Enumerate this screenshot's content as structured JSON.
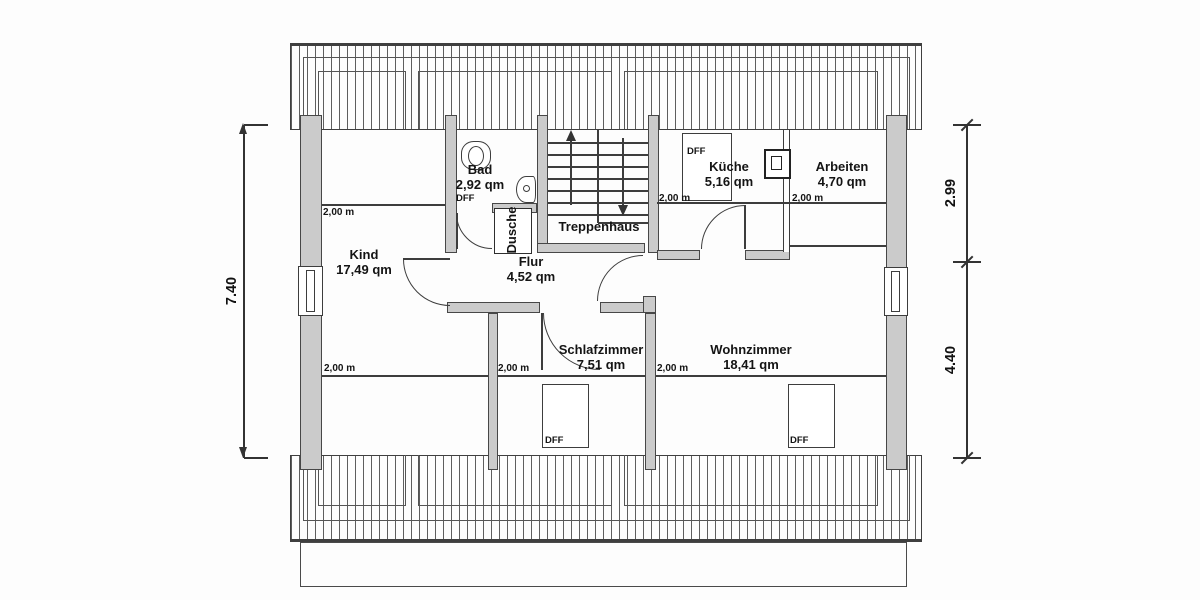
{
  "drawing": {
    "title": "Dachgeschoss Grundriss",
    "colors": {
      "wall_fill": "#cbcbcb",
      "line": "#3d3d3d",
      "background": "#fdfdfd"
    },
    "rooms": [
      {
        "id": "kind",
        "name": "Kind",
        "area": "17,49 qm",
        "cx": 364,
        "ty": 248,
        "rotated": false
      },
      {
        "id": "bad",
        "name": "Bad",
        "area": "2,92 qm",
        "cx": 480,
        "ty": 163,
        "rotated": false
      },
      {
        "id": "dusche",
        "name": "Dusche",
        "area": "",
        "cx": 512,
        "ty": 230,
        "rotated": true
      },
      {
        "id": "treppenhaus",
        "name": "Treppenhaus",
        "area": "",
        "cx": 599,
        "ty": 220,
        "rotated": false
      },
      {
        "id": "flur",
        "name": "Flur",
        "area": "4,52 qm",
        "cx": 531,
        "ty": 255,
        "rotated": false
      },
      {
        "id": "kueche",
        "name": "Küche",
        "area": "5,16 qm",
        "cx": 729,
        "ty": 160,
        "rotated": false
      },
      {
        "id": "arbeiten",
        "name": "Arbeiten",
        "area": "4,70 qm",
        "cx": 842,
        "ty": 160,
        "rotated": false
      },
      {
        "id": "schlafzimmer",
        "name": "Schlafzimmer",
        "area": "7,51 qm",
        "cx": 601,
        "ty": 343,
        "rotated": false
      },
      {
        "id": "wohnzimmer",
        "name": "Wohnzimmer",
        "area": "18,41 qm",
        "cx": 751,
        "ty": 343,
        "rotated": false
      }
    ],
    "height_marks": [
      {
        "label": "2,00 m",
        "x": 323,
        "y": 207
      },
      {
        "label": "2,00 m",
        "x": 659,
        "y": 193
      },
      {
        "label": "2,00 m",
        "x": 792,
        "y": 193
      },
      {
        "label": "2,00 m",
        "x": 324,
        "y": 363
      },
      {
        "label": "2,00 m",
        "x": 498,
        "y": 363
      },
      {
        "label": "2,00 m",
        "x": 657,
        "y": 363
      }
    ],
    "dff_labels": [
      {
        "label": "DFF",
        "x": 456,
        "y": 193
      },
      {
        "label": "DFF",
        "x": 687,
        "y": 146
      },
      {
        "label": "DFF",
        "x": 545,
        "y": 435
      },
      {
        "label": "DFF",
        "x": 790,
        "y": 435
      }
    ],
    "dimensions": {
      "left": "7.40",
      "right_top": "2.99",
      "right_bottom": "4.40"
    }
  }
}
